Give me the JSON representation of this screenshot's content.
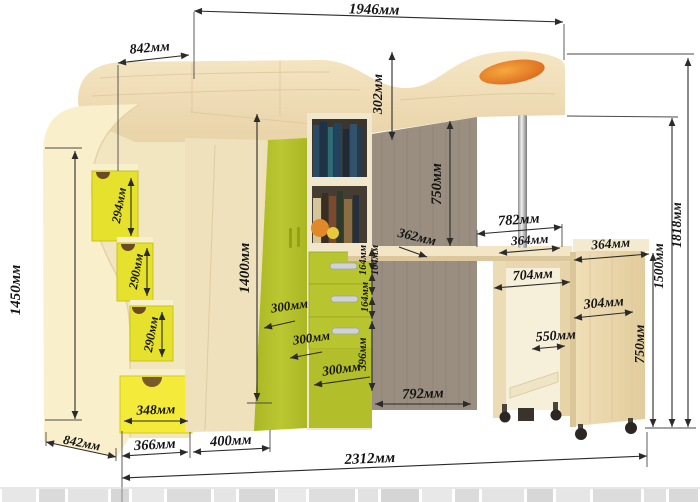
{
  "diagram": {
    "title": "loft-bed-dimension-diagram",
    "units": "мм",
    "colors": {
      "step_yellow": "#e5e12d",
      "drawer_yellow": "#f3ea39",
      "wardrobe_green": "#b5c22c",
      "wood_light": "#f0e0bb",
      "wood_pale": "#f9efca",
      "wood_dark": "#9a8e80",
      "orange_accent": "#e0751f",
      "dimension_line": "#2b2b2b"
    }
  },
  "dimensions": {
    "bed_length": "1946мм",
    "bed_head_depth": "842мм",
    "bed_rail_height": "302мм",
    "step_1_height": "294мм",
    "step_2_height": "290мм",
    "step_3_height": "290мм",
    "stairs_height": "1450мм",
    "stairs_drawer_width": "348мм",
    "stairs_side_depth": "842мм",
    "stairs_width": "366мм",
    "wardrobe_width": "400мм",
    "total_width": "2312мм",
    "wardrobe_height": "1400мм",
    "drawer_depth_1": "300мм",
    "drawer_depth_2": "300мм",
    "drawer_depth_3": "300мм",
    "shelf_depth": "362мм",
    "drawer_height_1": "164мм",
    "drawer_height_2": "164мм",
    "drawer_height_3": "164мм",
    "under_drawer_height": "396мм",
    "bed_to_desk_clearance": "750мм",
    "desk_area_width": "782мм",
    "desk_half_width": "364мм",
    "pedestal_width": "704мм",
    "pedestal_clearance": "550мм",
    "cabinet_top_depth": "364мм",
    "cabinet_depth": "304мм",
    "cabinet_height": "750мм",
    "height_under_bed": "1500мм",
    "total_height": "1818мм",
    "desk_width": "792мм"
  }
}
